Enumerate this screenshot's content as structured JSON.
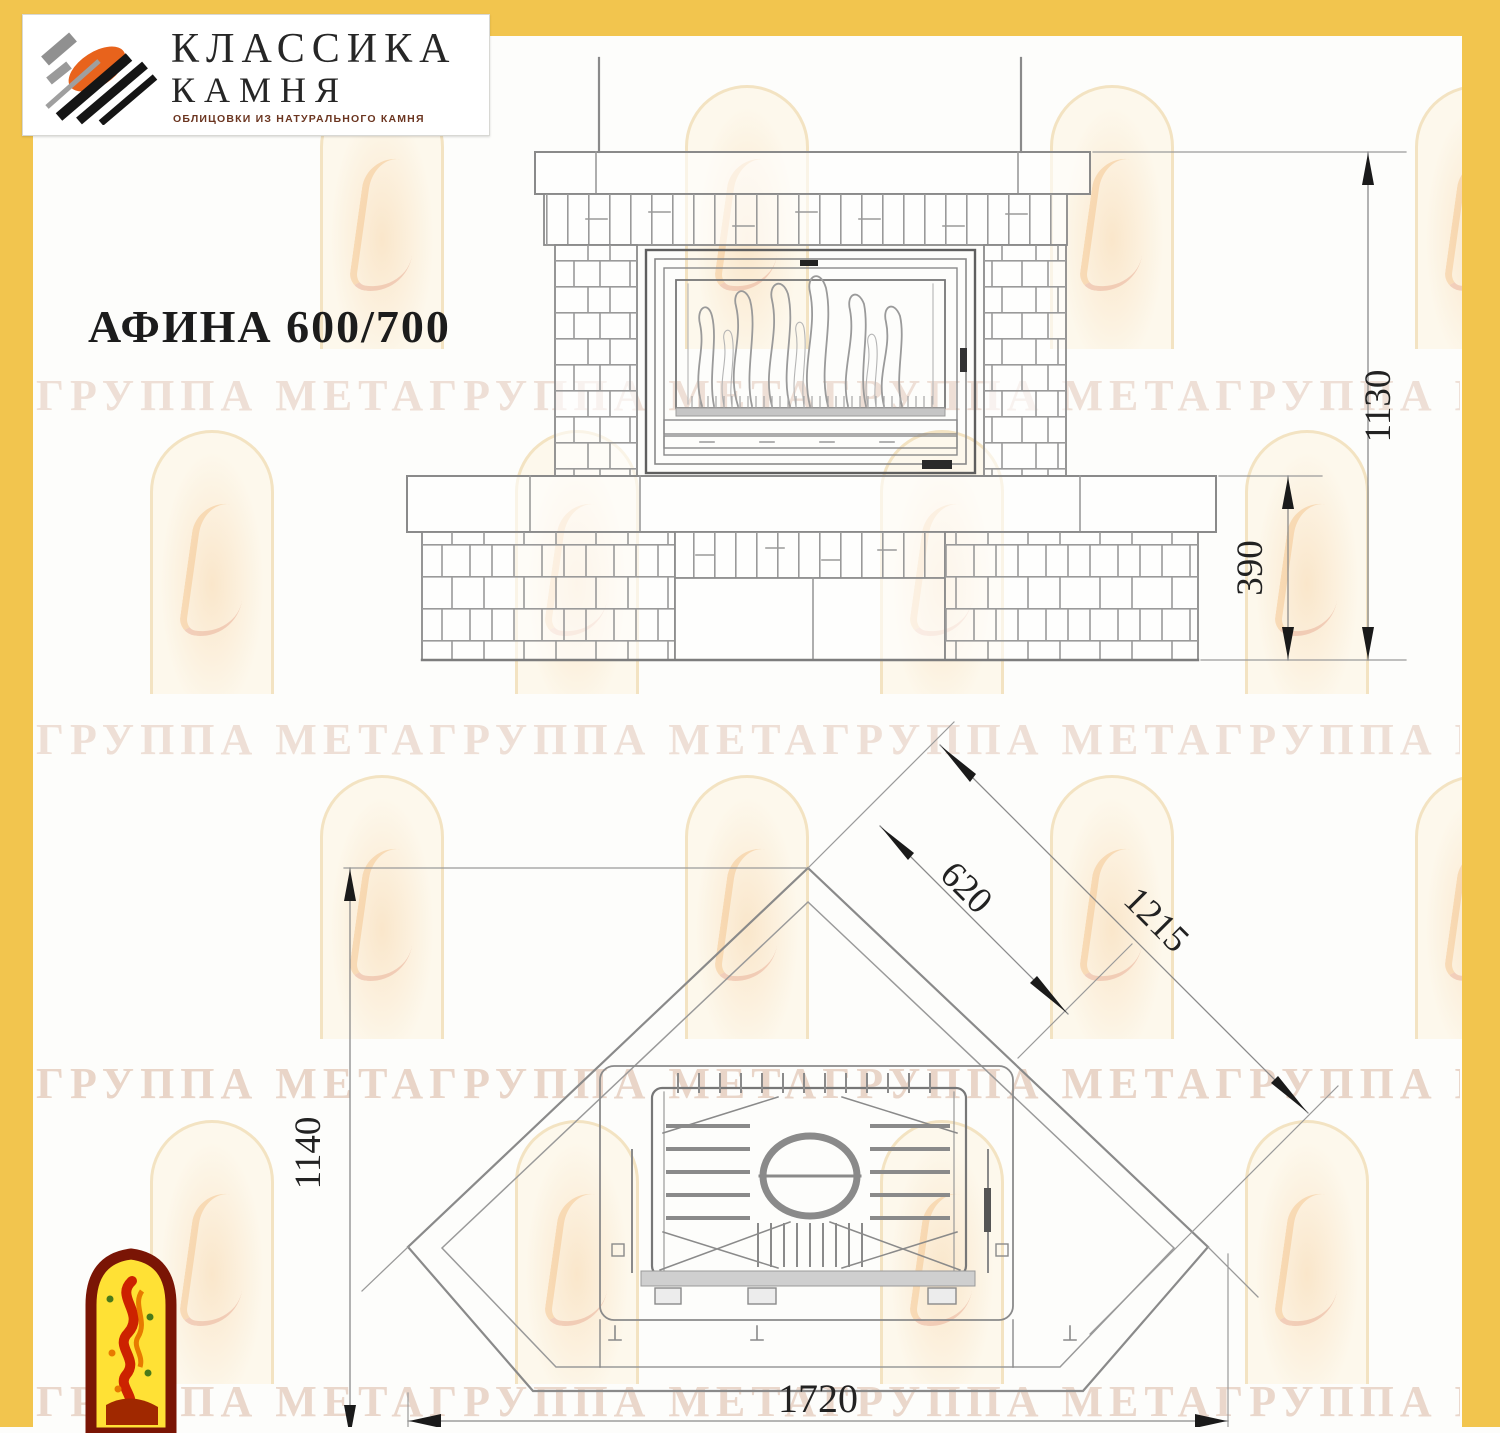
{
  "brand": {
    "line1": "КЛАССИКА",
    "line2": "КАМНЯ",
    "tagline": "ОБЛИЦОВКИ ИЗ НАТУРАЛЬНОГО КАМНЯ"
  },
  "title": "АФИНА 600/700",
  "front_view": {
    "height_total": "1130",
    "height_base": "390"
  },
  "plan_view": {
    "depth": "1140",
    "firebox_face": "620",
    "diagonal": "1215",
    "width": "1720"
  },
  "watermark": {
    "text": "ГРУППА МЕТАГРУППА МЕТАГРУППА МЕТАГРУППА МЕТА"
  },
  "colors": {
    "frame_yellow": "#F2C54E",
    "line_gray": "#8a8a8a",
    "ornament_red": "#7a1505",
    "ornament_yellow": "#FFE135",
    "logo_orange": "#e8631c"
  }
}
